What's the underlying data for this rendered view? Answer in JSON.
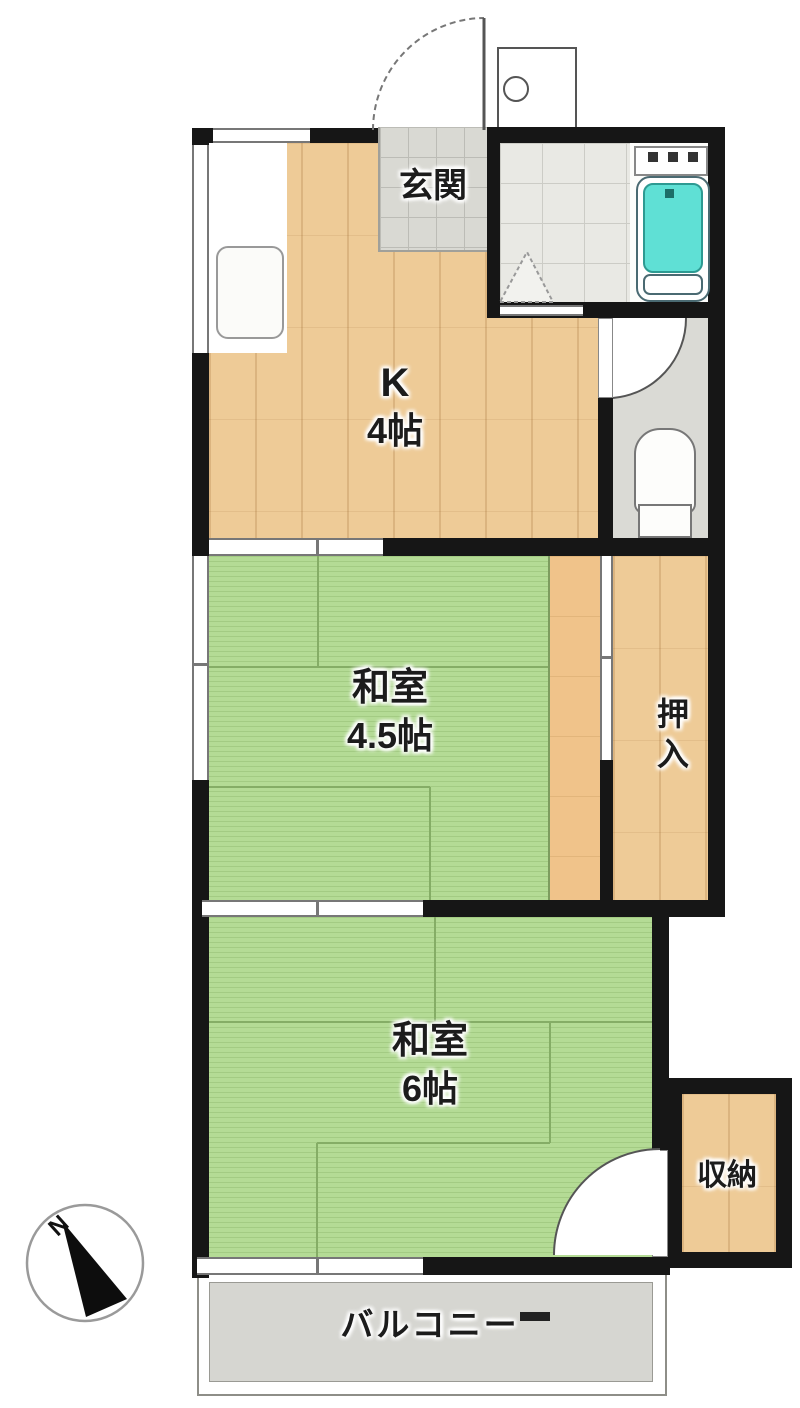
{
  "rooms": {
    "genkan": {
      "label": "玄関"
    },
    "kitchen": {
      "name": "K",
      "size": "4帖"
    },
    "japanese_room_45": {
      "name": "和室",
      "size": "4.5帖"
    },
    "oshiire": {
      "label": "押入"
    },
    "japanese_room_6": {
      "name": "和室",
      "size": "6帖"
    },
    "storage": {
      "label": "収納"
    },
    "balcony": {
      "label": "バルコニー"
    }
  },
  "compass": {
    "north_label": "N"
  },
  "colors": {
    "wall": "#161616",
    "tatami_green": "#b4db95",
    "wood_floor": "#eecb97",
    "tile_gray": "#d9d9d3",
    "bathtub_cyan": "#5fe0d5",
    "balcony_gray": "#d6d6d1"
  }
}
